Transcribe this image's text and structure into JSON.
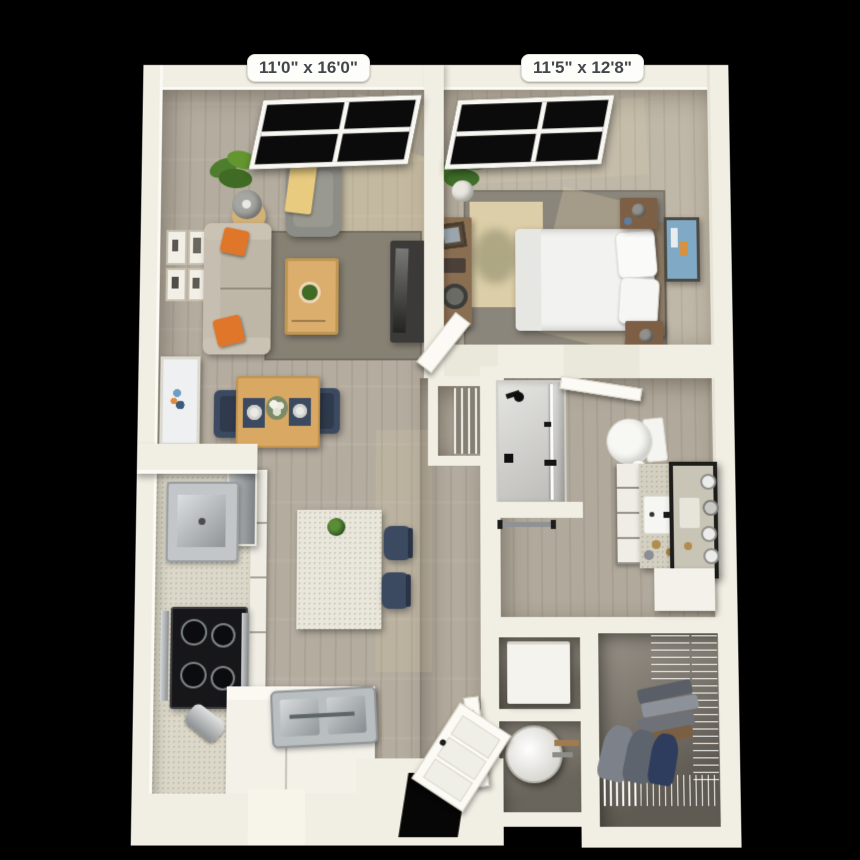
{
  "title": "one-bedroom apartment 3D floor plan",
  "background_color": "#000000",
  "dimension_labels": {
    "living_room": "11'0\" x 16'0\"",
    "bedroom": "11'5\" x 12'8\""
  },
  "palette": {
    "wall": "#f1eee3",
    "wood_floor": "#b4ac9e",
    "bedroom_floor": "#bfb7a7",
    "closet_floor": "#6a655c",
    "rug_gray": "#878174",
    "rug_tan": "#dccea8",
    "sofa_cream": "#beb6a7",
    "pillow_orange": "#e0762a",
    "armchair_gray": "#8d8d88",
    "throw_gold": "#e9cb80",
    "wood_furniture": "#d9a963",
    "navy": "#3c4a61",
    "tv_console_dark": "#3b3a38",
    "counter_speckle": "#dcd8c9",
    "stainless": "#9aa0a3",
    "bed_linen": "#f2f2f0",
    "nightstand_brown": "#7d5f46",
    "window_glass": "#0b0b0b"
  },
  "rooms": {
    "living_room": {
      "dimensions_label": "11'0\" x 16'0\"",
      "features": [
        "window",
        "potted-plant",
        "floor-lamp",
        "side-table",
        "sofa",
        "orange-throw-pillows",
        "armchair",
        "gold-throw-blanket",
        "gallery-wall-frames",
        "area-rug",
        "coffee-table",
        "coffee-table-plant",
        "tv-console",
        "television",
        "framed-art",
        "dining-table",
        "dining-chairs",
        "place-settings",
        "flower-vase"
      ]
    },
    "kitchen": {
      "features": [
        "half-wall-ledge",
        "refrigerator",
        "counter-run",
        "cabinet-fronts",
        "prep-sink",
        "cooktop-oven",
        "toaster",
        "lower-counter",
        "main-sink",
        "island",
        "island-plant",
        "bar-stools"
      ]
    },
    "bedroom": {
      "dimensions_label": "11'5\" x 12'8\"",
      "features": [
        "window",
        "potted-plant",
        "dresser-console",
        "decor-items",
        "area-rug",
        "accent-rug",
        "bed",
        "pillows",
        "headboard",
        "nightstands",
        "table-lamps",
        "framed-art",
        "bedroom-door"
      ]
    },
    "bathroom": {
      "features": [
        "walk-in-shower",
        "shower-head",
        "glass-panel",
        "floor-drain",
        "towel-bar",
        "toilet",
        "toilet-paper-roll",
        "vanity-drawers",
        "vanity-counter",
        "basin",
        "faucet",
        "leaning-mirror",
        "sconce-bulbs",
        "toiletries",
        "bathroom-door"
      ]
    },
    "linen_closet": {
      "features": [
        "slatted-shelves"
      ]
    },
    "laundry_closet": {
      "features": [
        "washer-dryer-unit"
      ]
    },
    "utility_closet": {
      "features": [
        "water-heater",
        "copper-pipes"
      ]
    },
    "walk_in_closet": {
      "features": [
        "wire-shelving",
        "folded-clothes",
        "hanging-clothes",
        "closet-door"
      ]
    },
    "entry": {
      "features": [
        "front-door",
        "door-opening"
      ]
    }
  }
}
